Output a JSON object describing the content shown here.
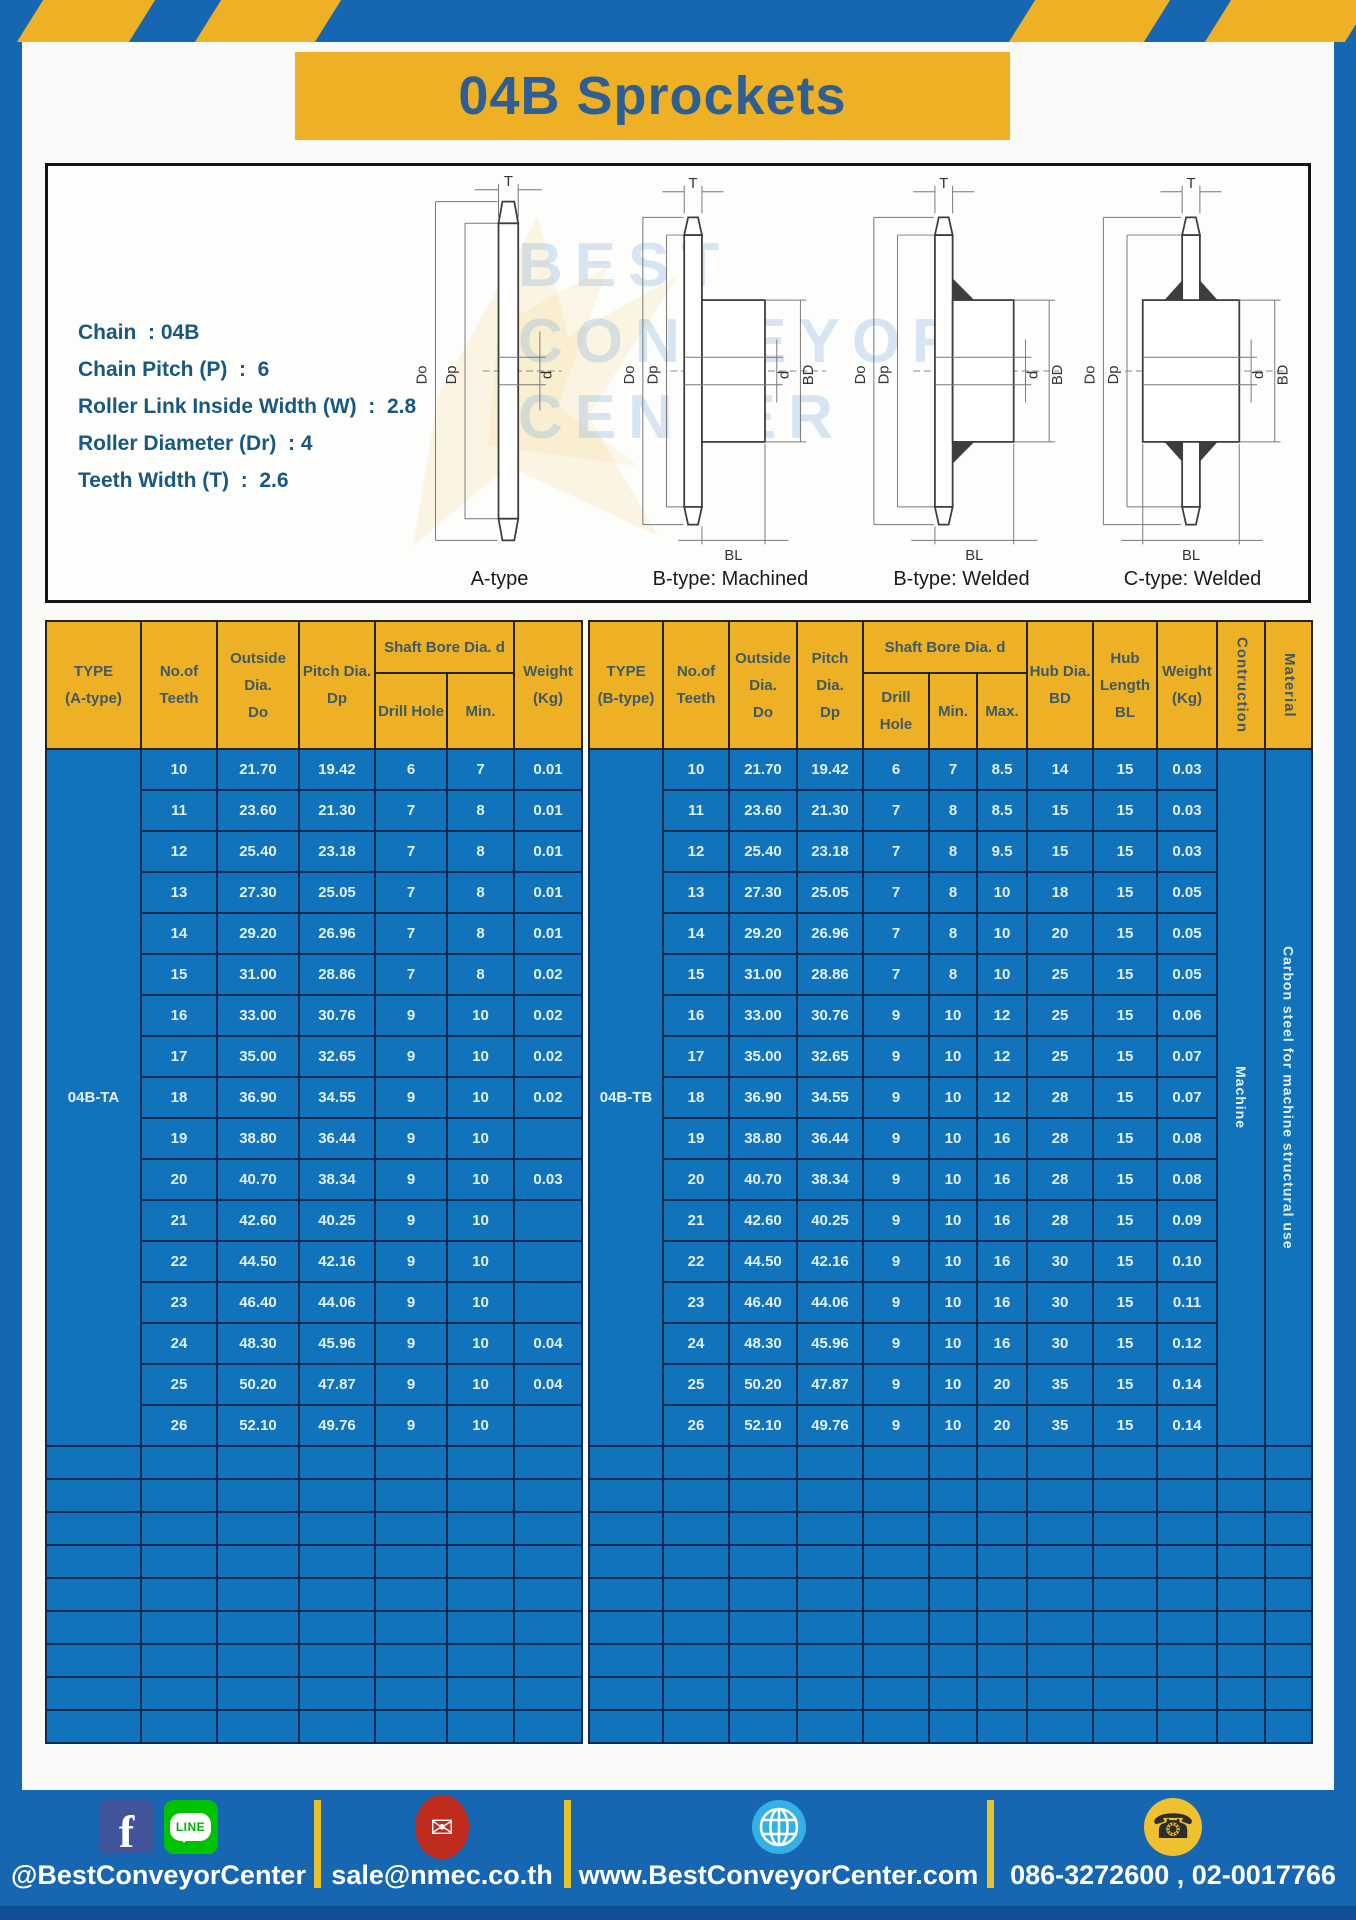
{
  "page": {
    "title": "04B Sprockets"
  },
  "specs": [
    "Chain  : 04B",
    "Chain Pitch (P)  :  6",
    "Roller Link Inside Width (W)  :  2.8",
    "Roller Diameter (Dr)  : 4",
    "Teeth Width (T)  :  2.6"
  ],
  "diagram": {
    "dims": {
      "t": "T",
      "do_": "Do",
      "dp": "Dp",
      "d": "d",
      "bd": "BD",
      "bl": "BL"
    },
    "captions": [
      "A-type",
      "B-type: Machined",
      "B-type: Welded",
      "C-type: Welded"
    ],
    "watermark": {
      "line1": "BEST",
      "line2": "CONVEYOR",
      "line3": "CENTER"
    }
  },
  "tables": {
    "left": {
      "headers": {
        "type": "TYPE\n(A-type)",
        "teeth": "No.of\nTeeth",
        "outside": "Outside\nDia.\nDo",
        "pitch": "Pitch Dia.\nDp",
        "shaft_bore": "Shaft Bore Dia. d",
        "drill_hole": "Drill Hole",
        "min": "Min.",
        "weight": "Weight\n(Kg)"
      },
      "group_label": "04B-TA",
      "empty_row_count": 9,
      "rows": [
        [
          "10",
          "21.70",
          "19.42",
          "6",
          "7",
          "0.01"
        ],
        [
          "11",
          "23.60",
          "21.30",
          "7",
          "8",
          "0.01"
        ],
        [
          "12",
          "25.40",
          "23.18",
          "7",
          "8",
          "0.01"
        ],
        [
          "13",
          "27.30",
          "25.05",
          "7",
          "8",
          "0.01"
        ],
        [
          "14",
          "29.20",
          "26.96",
          "7",
          "8",
          "0.01"
        ],
        [
          "15",
          "31.00",
          "28.86",
          "7",
          "8",
          "0.02"
        ],
        [
          "16",
          "33.00",
          "30.76",
          "9",
          "10",
          "0.02"
        ],
        [
          "17",
          "35.00",
          "32.65",
          "9",
          "10",
          "0.02"
        ],
        [
          "18",
          "36.90",
          "34.55",
          "9",
          "10",
          "0.02"
        ],
        [
          "19",
          "38.80",
          "36.44",
          "9",
          "10",
          ""
        ],
        [
          "20",
          "40.70",
          "38.34",
          "9",
          "10",
          "0.03"
        ],
        [
          "21",
          "42.60",
          "40.25",
          "9",
          "10",
          ""
        ],
        [
          "22",
          "44.50",
          "42.16",
          "9",
          "10",
          ""
        ],
        [
          "23",
          "46.40",
          "44.06",
          "9",
          "10",
          ""
        ],
        [
          "24",
          "48.30",
          "45.96",
          "9",
          "10",
          "0.04"
        ],
        [
          "25",
          "50.20",
          "47.87",
          "9",
          "10",
          "0.04"
        ],
        [
          "26",
          "52.10",
          "49.76",
          "9",
          "10",
          ""
        ]
      ]
    },
    "right": {
      "headers": {
        "type": "TYPE\n(B-type)",
        "teeth": "No.of\nTeeth",
        "outside": "Outside\nDia.\nDo",
        "pitch": "Pitch Dia.\nDp",
        "shaft_bore": "Shaft Bore Dia. d",
        "drill_hole": "Drill Hole",
        "min": "Min.",
        "max": "Max.",
        "hub_dia": "Hub Dia.\nBD",
        "hub_length": "Hub\nLength\nBL",
        "weight": "Weight\n(Kg)",
        "construction": "Contruction",
        "material": "Material"
      },
      "group_label": "04B-TB",
      "construction_value": "Machine",
      "material_value": "Carbon steel for machine structural use",
      "empty_row_count": 9,
      "rows": [
        [
          "10",
          "21.70",
          "19.42",
          "6",
          "7",
          "8.5",
          "14",
          "15",
          "0.03"
        ],
        [
          "11",
          "23.60",
          "21.30",
          "7",
          "8",
          "8.5",
          "15",
          "15",
          "0.03"
        ],
        [
          "12",
          "25.40",
          "23.18",
          "7",
          "8",
          "9.5",
          "15",
          "15",
          "0.03"
        ],
        [
          "13",
          "27.30",
          "25.05",
          "7",
          "8",
          "10",
          "18",
          "15",
          "0.05"
        ],
        [
          "14",
          "29.20",
          "26.96",
          "7",
          "8",
          "10",
          "20",
          "15",
          "0.05"
        ],
        [
          "15",
          "31.00",
          "28.86",
          "7",
          "8",
          "10",
          "25",
          "15",
          "0.05"
        ],
        [
          "16",
          "33.00",
          "30.76",
          "9",
          "10",
          "12",
          "25",
          "15",
          "0.06"
        ],
        [
          "17",
          "35.00",
          "32.65",
          "9",
          "10",
          "12",
          "25",
          "15",
          "0.07"
        ],
        [
          "18",
          "36.90",
          "34.55",
          "9",
          "10",
          "12",
          "28",
          "15",
          "0.07"
        ],
        [
          "19",
          "38.80",
          "36.44",
          "9",
          "10",
          "16",
          "28",
          "15",
          "0.08"
        ],
        [
          "20",
          "40.70",
          "38.34",
          "9",
          "10",
          "16",
          "28",
          "15",
          "0.08"
        ],
        [
          "21",
          "42.60",
          "40.25",
          "9",
          "10",
          "16",
          "28",
          "15",
          "0.09"
        ],
        [
          "22",
          "44.50",
          "42.16",
          "9",
          "10",
          "16",
          "30",
          "15",
          "0.10"
        ],
        [
          "23",
          "46.40",
          "44.06",
          "9",
          "10",
          "16",
          "30",
          "15",
          "0.11"
        ],
        [
          "24",
          "48.30",
          "45.96",
          "9",
          "10",
          "16",
          "30",
          "15",
          "0.12"
        ],
        [
          "25",
          "50.20",
          "47.87",
          "9",
          "10",
          "20",
          "35",
          "15",
          "0.14"
        ],
        [
          "26",
          "52.10",
          "49.76",
          "9",
          "10",
          "20",
          "35",
          "15",
          "0.14"
        ]
      ]
    }
  },
  "footer": {
    "facebook_letter": "f",
    "line_label": "LINE",
    "social_handle": "@BestConveyorCenter",
    "email": "sale@nmec.co.th",
    "website": "www.BestConveyorCenter.com",
    "phones": "086-3272600 , 02-0017766",
    "mail_glyph": "✉",
    "phone_glyph": "☎"
  },
  "colors": {
    "frame_blue": "#1766b1",
    "accent_yellow": "#eeb024",
    "table_blue": "#1273bd",
    "border_navy": "#0b2b50",
    "title_text": "#2d5f94"
  }
}
